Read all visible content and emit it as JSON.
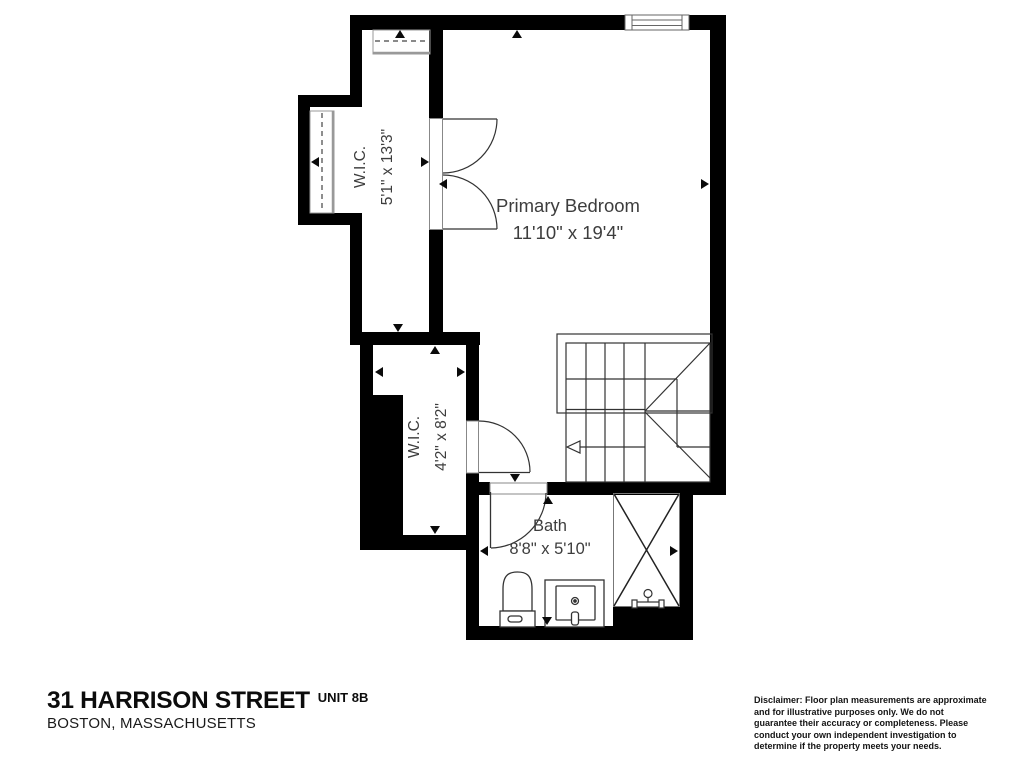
{
  "plan": {
    "rooms": [
      {
        "name": "Primary Bedroom",
        "dims": "11'10\" x 19'4\""
      },
      {
        "name": "W.I.C.",
        "dims": "5'1\" x 13'3\""
      },
      {
        "name": "W.I.C.",
        "dims": "4'2\" x 8'2\""
      },
      {
        "name": "Bath",
        "dims": "8'8\" x 5'10\""
      }
    ],
    "symbols": [
      "window",
      "double-door",
      "hinged-door",
      "staircase",
      "closet-rod",
      "toilet",
      "sink-vanity",
      "shower"
    ],
    "colors": {
      "wall": "#000000",
      "line": "#333333",
      "label": "#3d3d3d",
      "background": "#ffffff"
    }
  },
  "title_block": {
    "address": "31 HARRISON STREET",
    "unit": "UNIT 8B",
    "city": "BOSTON, MASSACHUSETTS"
  },
  "disclaimer": "Disclaimer: Floor plan measurements are approximate and for illustrative purposes only. We do not guarantee their accuracy or completeness. Please conduct your own independent investigation to determine if the property meets your needs."
}
